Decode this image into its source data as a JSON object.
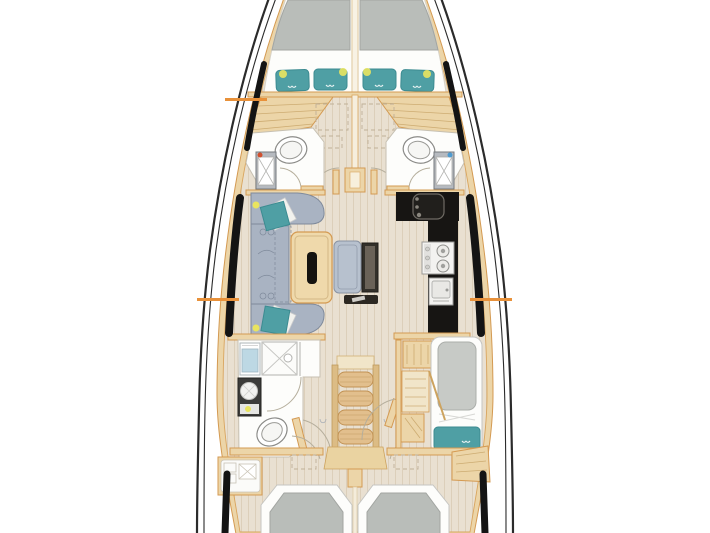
{
  "diagram": {
    "type": "yacht-interior-floor-plan",
    "view": "top-down deck plan",
    "orientation": "bow-up"
  },
  "palette": {
    "bg": "#ffffff",
    "hull_line": "#2b2b2b",
    "glass_black": "#141414",
    "floor": "#e9e0d1",
    "floor_grain": "#dccfba",
    "wood": "#ecd5a8",
    "wood_border": "#d49a52",
    "wood_light": "#f1e5c9",
    "wood_step": "#e2bf8d",
    "room_white": "#fdfdfb",
    "mattress": "#b9bdb9",
    "pillow_teal": "#4f9fa4",
    "pillow_teal_dark": "#3c8b91",
    "sofa": "#a9b3c2",
    "sofa_line": "#7f8a9b",
    "bench": "#b7c1ce",
    "tv_panel": "#33302a",
    "counter": "#171513",
    "appliance": "#f3f2f0",
    "appliance_line": "#9b9a97",
    "shower_blue": "#bdd8e4",
    "marker_orange": "#e8913a",
    "lamp_yellow": "#e9e45f",
    "red_dot": "#d0502e",
    "blue_dot": "#4f9bcf",
    "door_arc": "#b5ae9c"
  },
  "regions": [
    "forward-owner-cabin",
    "port-head",
    "starboard-head",
    "salon-seating",
    "dining-table",
    "galley",
    "aft-port-bathroom",
    "companionway-stairs",
    "starboard-aft-berth",
    "port-aft-cabin",
    "starboard-aft-cabin"
  ],
  "markers": [
    {
      "name": "port-forward-section-marker",
      "x": 225,
      "y": 98,
      "width": 42,
      "height": 3
    },
    {
      "name": "port-midship-section-marker",
      "x": 197,
      "y": 298,
      "width": 42,
      "height": 3
    },
    {
      "name": "starboard-midship-section-marker",
      "x": 470,
      "y": 298,
      "width": 42,
      "height": 3
    }
  ]
}
